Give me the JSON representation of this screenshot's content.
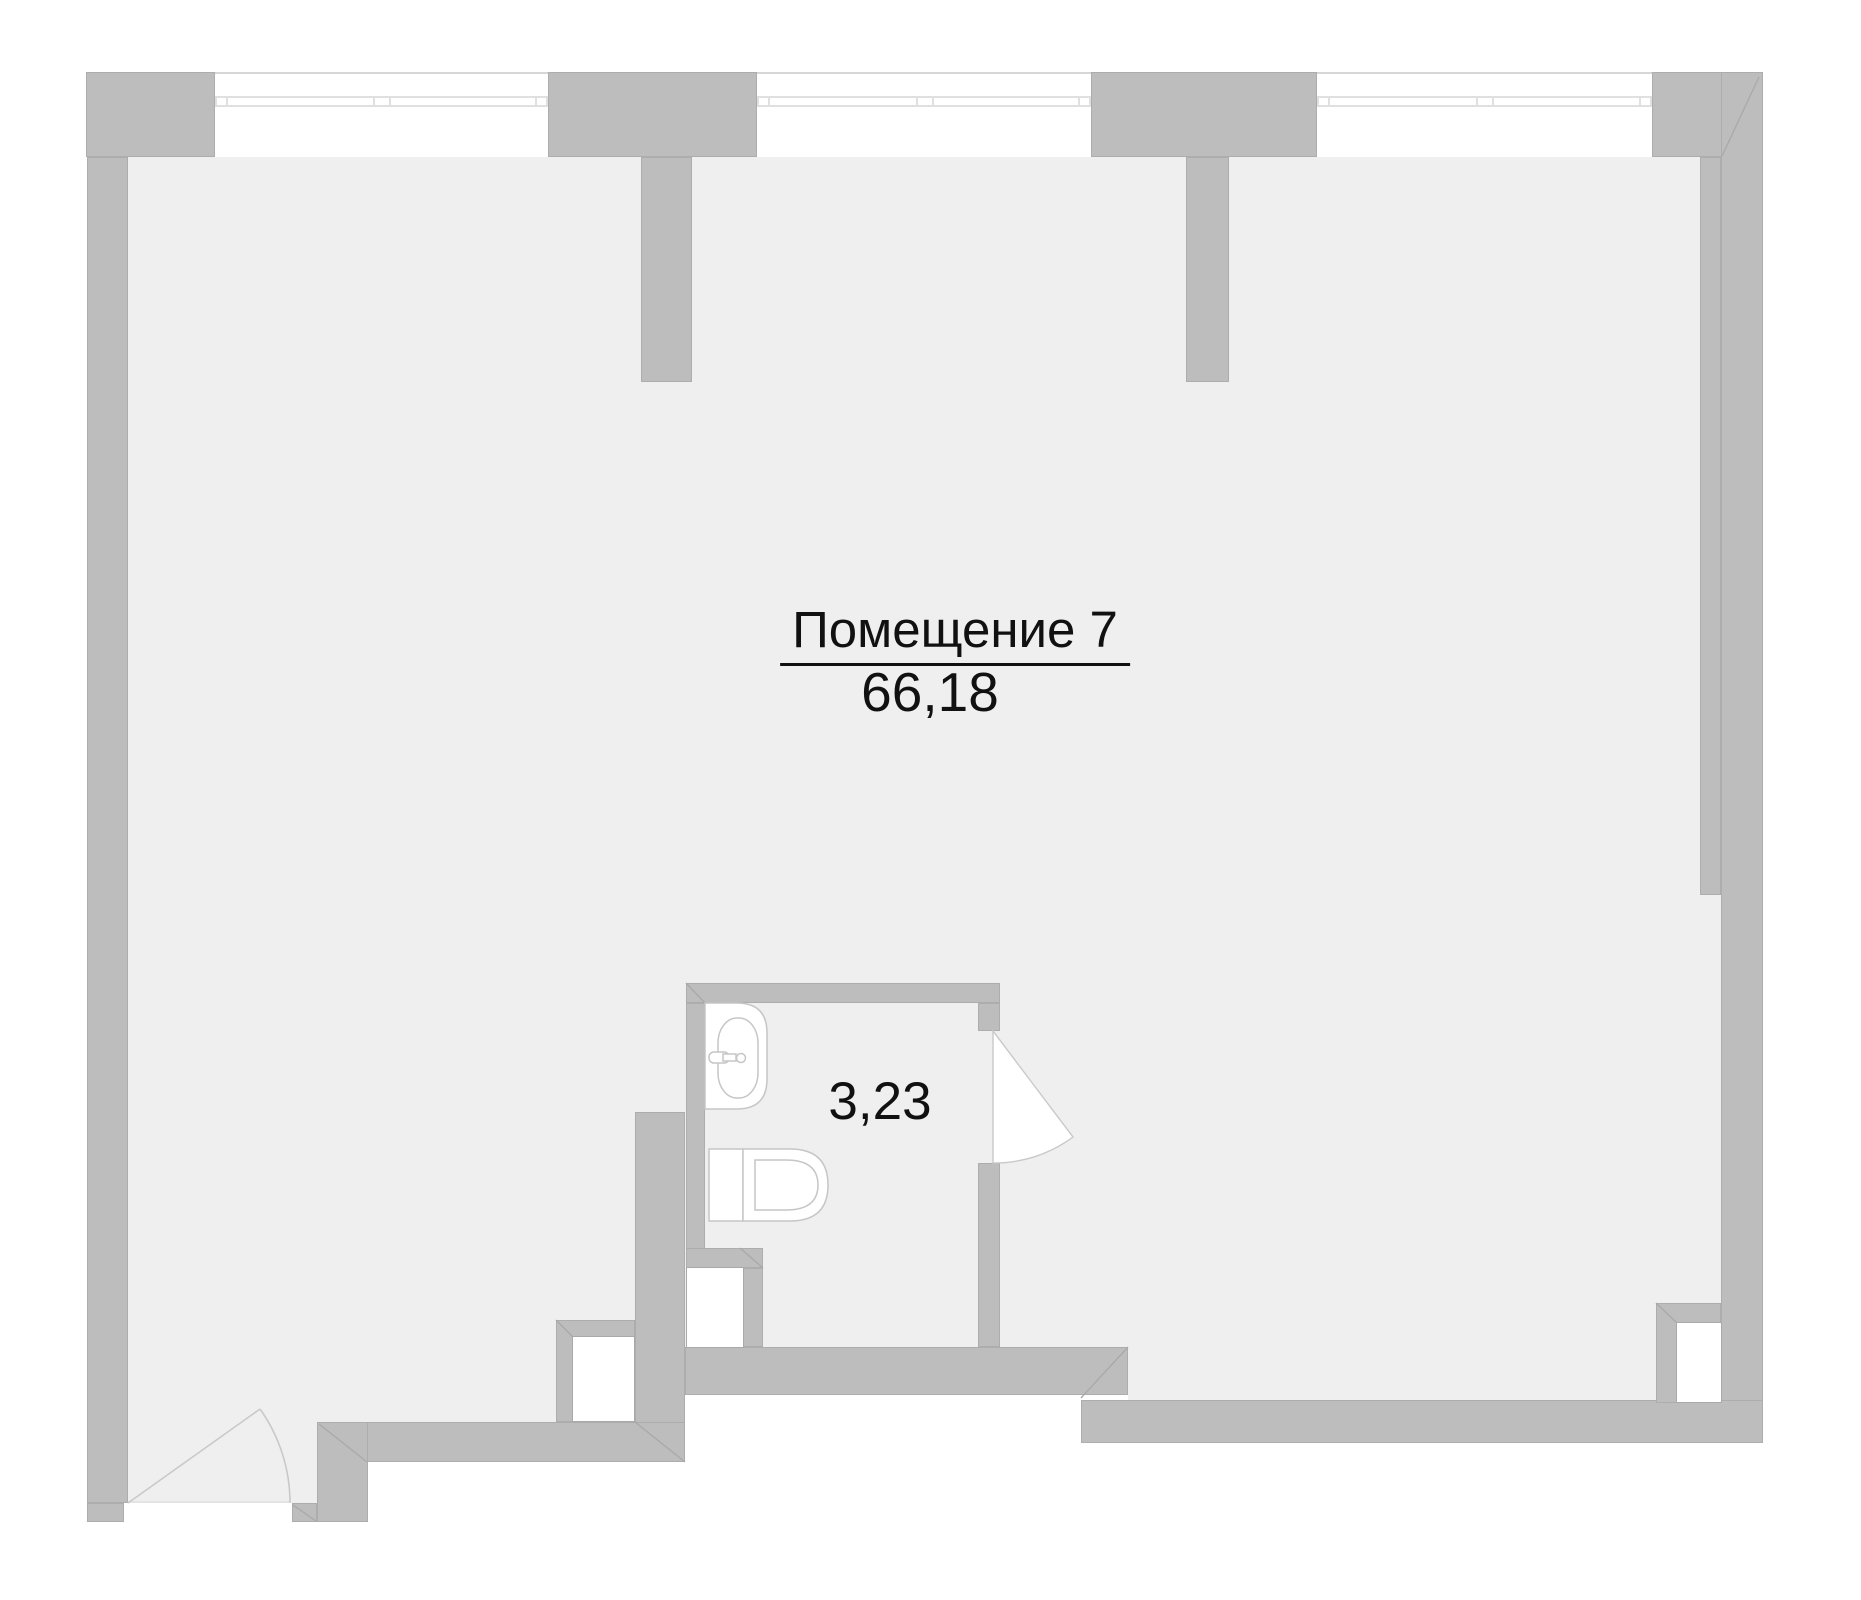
{
  "rooms": {
    "main": {
      "label": "Помещение 7",
      "area": "66,18"
    },
    "bathroom": {
      "area": "3,23"
    }
  },
  "icons": {
    "sink": "sink-fixture",
    "toilet": "toilet-fixture",
    "doors": "door-swing-arc"
  },
  "colors": {
    "bg": "#ffffff",
    "floor": "#efefef",
    "wall": "#bdbdbd",
    "seam": "rgba(100,100,100,0.18)",
    "outline": "#a9a9a9",
    "winline": "#e0e0e0",
    "topline": "#d6d6d6",
    "fixline": "#c6c6c6",
    "doorline": "#c9c9c9",
    "text": "#111111"
  }
}
